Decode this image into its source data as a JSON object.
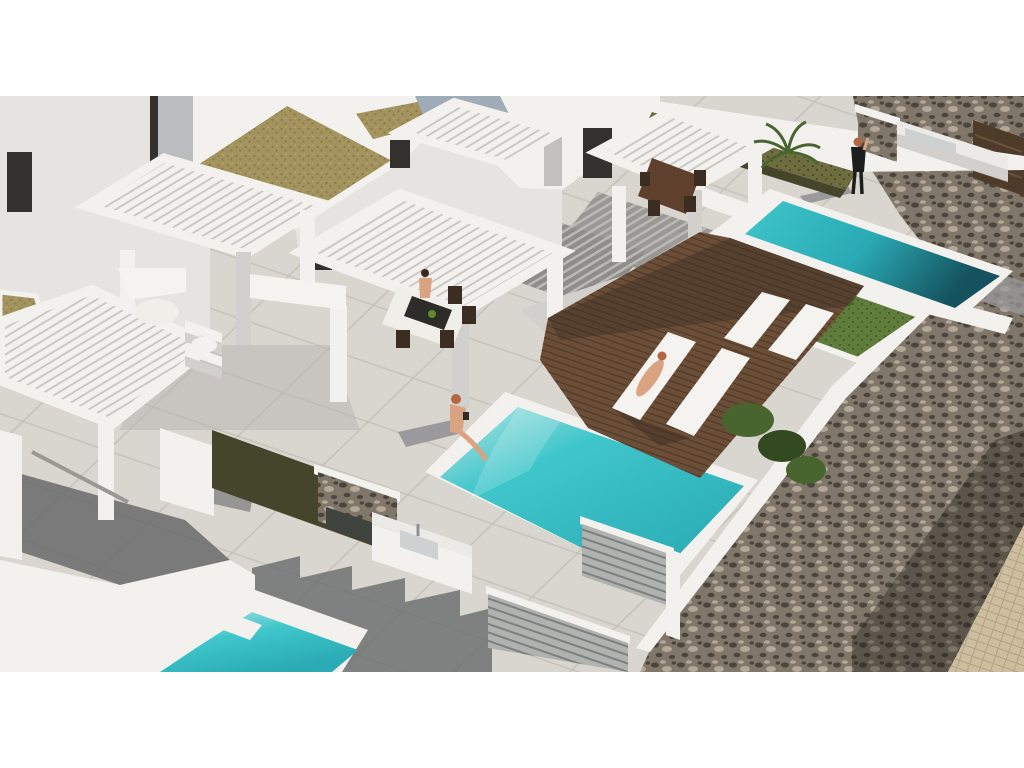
{
  "meta": {
    "description": "Aerial 3D architectural rendering of modern white villas with private turquoise pools, wooden sun decks with loungers, pergolas, outdoor kitchens and a rubble stone perimeter wall; letterboxed 16:9 frame on white",
    "frame": {
      "content_top": 96,
      "content_bottom": 672
    },
    "people_count": "4",
    "pool_count": "3"
  },
  "scene": {
    "villas": "white modern villas with slatted pergolas",
    "pool_upper": "upper right pool",
    "pool_center": "central pool with seated woman",
    "pool_lower": "bottom left pool",
    "deck": "wooden deck with four white sun loungers",
    "stone_wall": "rubble stone perimeter wall",
    "kitchen_top": "outdoor kitchen with sink near stone wall",
    "kitchen_center": "stone clad outdoor kitchen with sink",
    "screens": "grey slatted privacy screens",
    "green_roof": "gravel green roof",
    "palm": "palm plant",
    "people": "standing woman, woman sitting at pool edge, woman on lounger, woman at dining table"
  },
  "colors": {
    "letterbox": "#ffffff",
    "backdrop": "#e9e7e3",
    "paving_base": "#d9d6cf",
    "paving_joint": "#c1beb5",
    "shadow_dark": "#686a6c",
    "shadow_mid": "#9a999b",
    "shadow_soft": "#b3b2af",
    "stripe_base": "#8e8d8b",
    "stripe_light": "#bab9b5",
    "wall_white": "#f2f1ed",
    "wall_light": "#e6e4e0",
    "wall_shade": "#d2d0cc",
    "wall_dark": "#c2c0bc",
    "slat_gap": "#c6c5c1",
    "dark_opening": "#33312d",
    "glass": "#b9bdbf",
    "glass_blue": "#9fabb7",
    "khaki_roof": "#a3935e",
    "khaki_dot": "#8b7b4a",
    "olive_grass": "#6e6d40",
    "olive_dark": "#45452c",
    "green_grass": "#5f7c3a",
    "green_dark": "#41592b",
    "bush": "#49652f",
    "bush_dark": "#33491f",
    "pool_pale": "#b7e6e2",
    "pool_bright": "#3fc6cb",
    "pool_mid": "#2aaab4",
    "pool_deep": "#14525e",
    "deck_base": "#6b4e37",
    "deck_line": "#523a28",
    "deck_shade": "#3f3025",
    "lounger_white": "#f4f3ef",
    "stone_base": "#80776a",
    "stone_dark": "#4c453b",
    "stone_light": "#b3a897",
    "cobble_base": "#cdbe9f",
    "cobble_joint": "#b2a283",
    "screen_gray": "#b0b2af",
    "screen_line": "#7c8081",
    "table_brown": "#5e402d",
    "chair_brown": "#3c2d22",
    "table_white": "#efeee9",
    "runner_dark": "#2e2c28",
    "skin": "#d9a382",
    "hair_red": "#b5653f",
    "outfit_black": "#1d1d1d",
    "counter_white": "#eceae6",
    "sink_inner": "#cdd1d1",
    "counter_dark": "#40443f",
    "gate_brown": "#4e3b2a",
    "gate_line": "#6a5238"
  }
}
